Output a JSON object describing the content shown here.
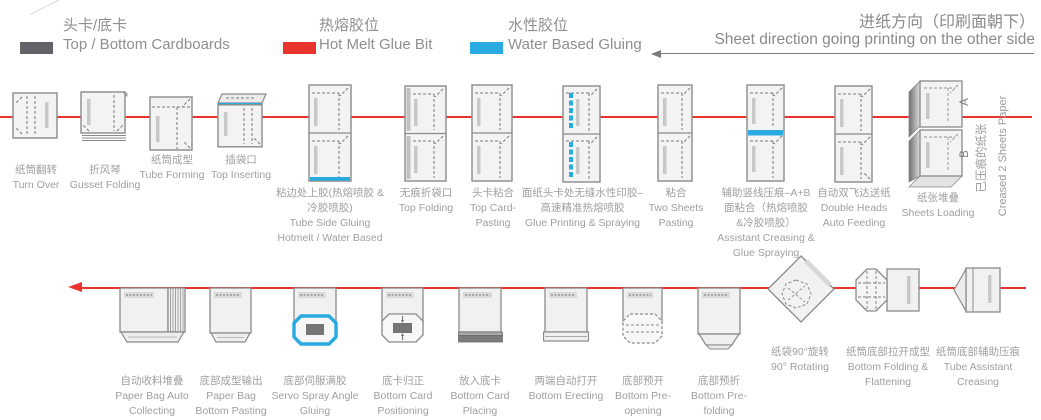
{
  "legend": {
    "items": [
      {
        "cn": "头卡/底卡",
        "en": "Top / Bottom Cardboards",
        "color": "#626366"
      },
      {
        "cn": "热熔胶位",
        "en": "Hot Melt Glue Bit",
        "color": "#e8342c"
      },
      {
        "cn": "水性胶位",
        "en": "Water Based Gluing",
        "color": "#29abe2"
      }
    ]
  },
  "direction": {
    "cn": "进纸方向（印刷面朝下）",
    "en": "Sheet direction going printing on the other side"
  },
  "colors": {
    "flow_red": "#e8342c",
    "glue_blue": "#29abe2",
    "cardboard_gray": "#626366"
  },
  "row1": {
    "stations": [
      {
        "cn": "纸筒翻转",
        "en": "Turn Over"
      },
      {
        "cn": "折风琴",
        "en": "Gusset Folding"
      },
      {
        "cn": "纸筒成型",
        "en": "Tube Forming"
      },
      {
        "cn": "插袋口",
        "en": "Top Inserting"
      },
      {
        "cn": "粘边处上胶(热熔喷胶 &\n冷胶喷胶)",
        "en": "Tube Side Gluing\nHotmelt / Water Based"
      },
      {
        "cn": "无痕折袋口",
        "en": "Top Folding"
      },
      {
        "cn": "头卡粘合",
        "en": "Top Card-\nPasting"
      },
      {
        "cn": "面纸头卡处无缝水性印胶–\n高速精准热熔喷胶",
        "en": "Glue Printing & Spraying"
      },
      {
        "cn": "粘合",
        "en": "Two Sheets\nPasting"
      },
      {
        "cn": "辅助竖线压痕–A+B\n面粘合（热熔喷胶\n&冷胶喷胶）",
        "en": "Assistant Creasing &\nGlue Spraying"
      },
      {
        "cn": "自动双飞达送纸",
        "en": "Double Heads\nAuto Feeding"
      },
      {
        "cn": "纸张堆叠",
        "en": "Sheets Loading"
      }
    ],
    "side_note": {
      "cn": "已压痕的纸张",
      "en": "Creased 2 Sheets Paper",
      "marker_a": "A",
      "marker_b": "B"
    }
  },
  "row2": {
    "stations": [
      {
        "cn": "自动收料堆叠",
        "en": "Paper Bag Auto\nCollecting"
      },
      {
        "cn": "底部成型输出",
        "en": "Paper Bag\nBottom Pasting"
      },
      {
        "cn": "底部伺服满胶",
        "en": "Servo Spray Angle\nGluing"
      },
      {
        "cn": "底卡归正",
        "en": "Bottom Card\nPositioning"
      },
      {
        "cn": "放入底卡",
        "en": "Bottom Card\nPlacing"
      },
      {
        "cn": "两端自动打开",
        "en": "Bottom Erecting"
      },
      {
        "cn": "底部预开",
        "en": "Bottom Pre-\nopening"
      },
      {
        "cn": "底部预折",
        "en": "Bottom Pre-\nfolding"
      },
      {
        "cn": "纸袋90°旋转",
        "en": "90° Rotating"
      },
      {
        "cn": "纸筒底部拉开成型",
        "en": "Bottom Folding &\nFlattening"
      },
      {
        "cn": "纸筒底部辅助压痕",
        "en": "Tube Assistant\nCreasing"
      }
    ]
  }
}
